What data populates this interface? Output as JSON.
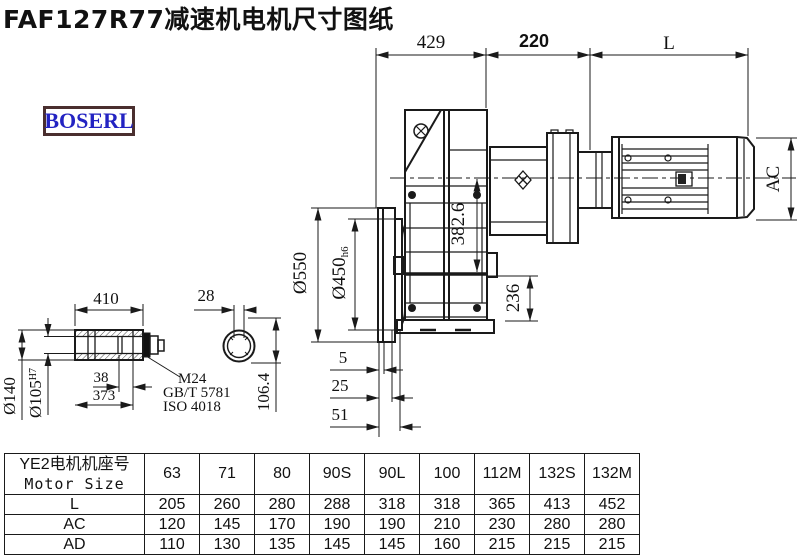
{
  "title": "FAF127R77减速机电机尺寸图纸",
  "logo": {
    "text": "BOSERL"
  },
  "colors": {
    "line": "#1a1a1a",
    "logo_text": "#2323c2",
    "logo_border": "#4a2f2f"
  },
  "drawing": {
    "dim_429": "429",
    "dim_220": "220",
    "dim_L": "L",
    "dim_AC": "AC",
    "dim_550": "Ø550",
    "dim_450": "Ø450",
    "dim_450_suffix": "h6",
    "dim_382": "382.6",
    "dim_236": "236",
    "dim_410": "410",
    "dim_28": "28",
    "dim_140": "Ø140",
    "dim_105": "Ø105",
    "dim_105_sup": "H7",
    "dim_38": "38",
    "dim_373": "373",
    "dim_106": "106.4",
    "dim_5": "5",
    "dim_25": "25",
    "dim_51": "51",
    "leader_m24": "M24",
    "leader_gbt": "GB/T 5781",
    "leader_iso": "ISO 4018"
  },
  "table": {
    "header_cn": "YE2电机机座号",
    "header_en": "Motor Size",
    "columns": [
      "63",
      "71",
      "80",
      "90S",
      "90L",
      "100",
      "112M",
      "132S",
      "132M"
    ],
    "rows": [
      {
        "label": "L",
        "values": [
          205,
          260,
          280,
          288,
          318,
          318,
          365,
          413,
          452
        ]
      },
      {
        "label": "AC",
        "values": [
          120,
          145,
          170,
          190,
          190,
          210,
          230,
          280,
          280
        ]
      },
      {
        "label": "AD",
        "values": [
          110,
          130,
          135,
          145,
          145,
          160,
          215,
          215,
          215
        ]
      }
    ]
  }
}
